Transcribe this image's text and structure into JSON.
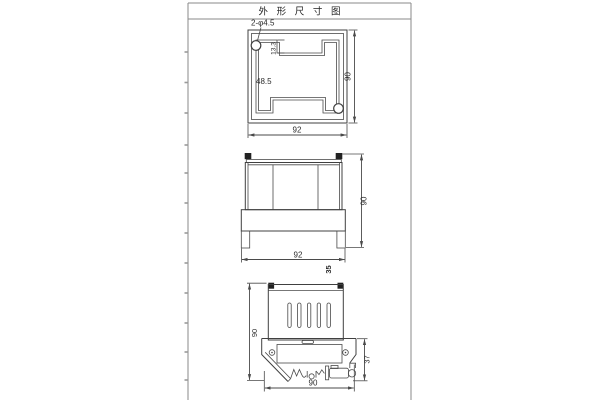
{
  "title": "外 形 尺 寸 图",
  "top_view": {
    "holes": "2-φ4.5",
    "notch": "13.3",
    "inner": "48.5",
    "width": "92",
    "height": "90"
  },
  "front_view": {
    "width": "92",
    "height": "90",
    "depth": "35"
  },
  "side_view": {
    "height": "90",
    "clip": "37",
    "width": "90"
  },
  "colors": {
    "line": "#404040",
    "frame": "#8a8a8a",
    "text": "#2b2b2b",
    "background": "#ffffff"
  }
}
